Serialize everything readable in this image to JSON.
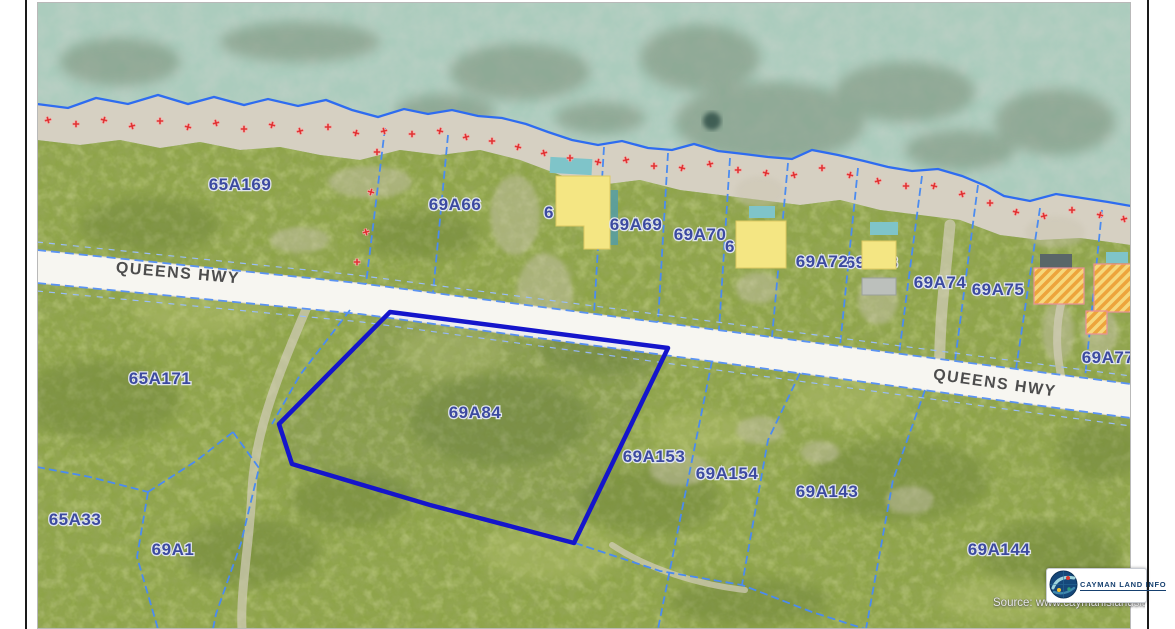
{
  "map": {
    "road_label": "QUEENS HWY",
    "parcels": {
      "p65A169": "65A169",
      "p69A66": "69A66",
      "p69A69": "69A69",
      "p69A70": "69A70",
      "p69A72": "69A72",
      "p69A73": "69A73",
      "p69A74": "69A74",
      "p69A75": "69A75",
      "p69A77": "69A77",
      "p65A171": "65A171",
      "p69A84": "69A84",
      "p69A153": "69A153",
      "p69A154": "69A154",
      "p69A143": "69A143",
      "p69A144": "69A144",
      "p65A33": "65A33",
      "p69A1": "69A1"
    },
    "partial_labels": {
      "f1": "6",
      "f2": "6"
    },
    "selected_parcel": "69A84",
    "colors": {
      "water": "#abccbd",
      "land": "#8ea448",
      "shore": "#d6d0c2",
      "road": "#f7f6f1",
      "parcel_line": "#4b8bf0",
      "selected_boundary": "#1515cb",
      "label_text": "#3c4aa0",
      "marker_red": "#e03434",
      "building_yellow": "#f4e683",
      "building_hatch": "#f0a93d",
      "pool_teal": "#7fc4c9"
    },
    "logo": {
      "text": "CAYMAN LAND INFO"
    },
    "source_text": "Source: www.caymanislandsland"
  }
}
